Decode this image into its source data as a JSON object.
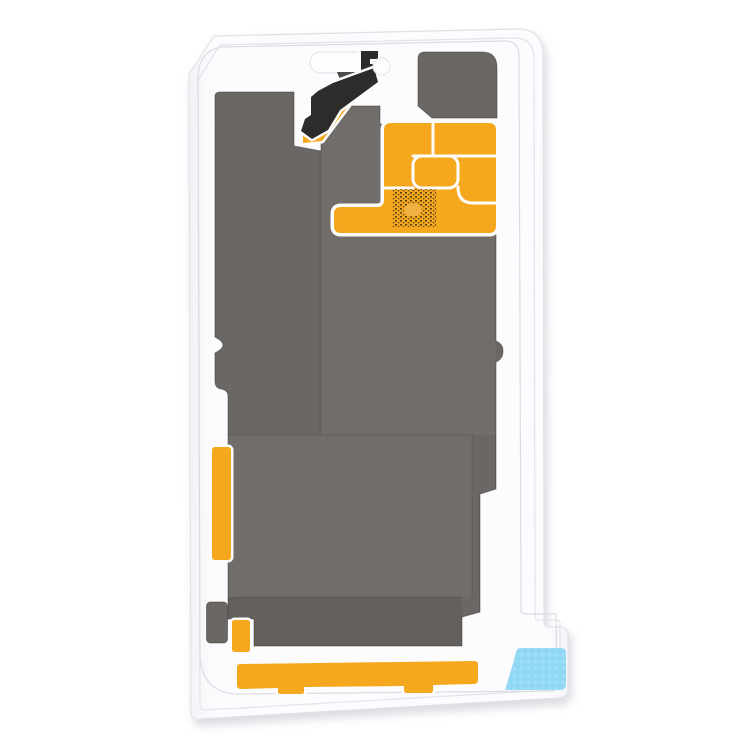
{
  "image": {
    "subject": "Top-down product photo of an LCD heat sink graphite film sticker for a smartphone, white release liner sheet with dark graphite layers, amber kapton tape sections, and a light blue pull tab",
    "background": "plain white"
  },
  "colors": {
    "page_bg": "#ffffff",
    "sheet": "#fcfcfe",
    "sheet_shade_edge": "#ededf2",
    "cutout_white": "#fdfdfe",
    "graphite": "#6b6764",
    "graphite_island": "#6b6764",
    "graphite_foot": "#6b6764",
    "flex_black": "#2e2c2b",
    "flex_gray": "#4e4b49",
    "kapton": "#f5a71e",
    "white_line": "#fcfcfd",
    "qr_dark": "#45350f",
    "qr_dark2": "#5c4614",
    "qr_blob": "#f2b347",
    "blue": "#8fd7f4",
    "blue_dot": "#a9e2f9",
    "shadow": "#a3a3b5"
  },
  "parts": {
    "liner": "white release liner sheet",
    "graphite_main": "main graphite heat-dissipation layer",
    "graphite_island": "upper-right graphite patch",
    "graphite_foot": "lower-left graphite tab",
    "kapton_block": "upper-right kapton film block with die-cut lines",
    "kapton_strip_left": "left kapton strip",
    "kapton_strip_small": "lower-left small kapton strip",
    "kapton_bar_bottom": "bottom kapton bar",
    "flex": "top flex-shaped black graphite cut",
    "qr_patch": "laser-etched code patch",
    "blue_tab": "blue textured pull-film tab",
    "earpiece_cutout": "pill-shaped die cutout",
    "camera_cutout": "round die cutout"
  }
}
